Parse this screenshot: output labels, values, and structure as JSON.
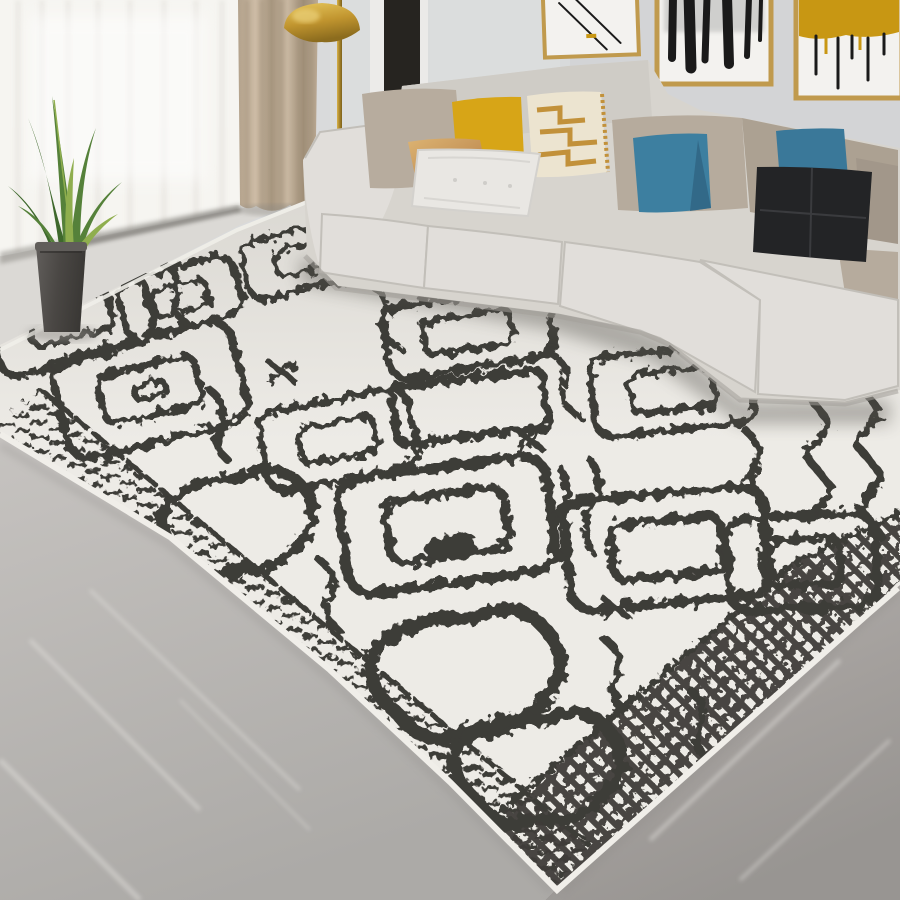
{
  "scene": {
    "setting": "bright living room corner: L-shaped light gray sectional sofa with throw pillows on a large ivory berber-style rug, gold-framed abstract wall art, brass dome floor lamp, sheer white and beige curtains, snake plant in a dark pot, gray marble tile floor",
    "colors": {
      "wall": "#d9dadb",
      "wall-dark": "#cdcfd1",
      "sheer": "#f6f5f1",
      "sheer-shade": "#e6e4df",
      "drape": "#c0af9a",
      "drape-dark": "#a2917a",
      "drape-light": "#d2c3ae",
      "molding": "#ecebe9",
      "panel-dark": "#262420",
      "frame-gold": "#c09a4d",
      "art-bg": "#f3f2ef",
      "art-ink": "#1a1a1a",
      "art-mustard": "#c89713",
      "lamp-gold": "#c79b33",
      "lamp-gold-dark": "#8f6f1d",
      "lamp-gold-light": "#ecd27a",
      "sofa": "#d7d4ce",
      "sofa-light": "#e1deda",
      "sofa-mid": "#cfccc6",
      "sofa-dark": "#a39f99",
      "cushion-taupe": "#b6ab9d",
      "cushion-taupe-mid": "#aca192",
      "cushion-taupe-dark": "#a2978a",
      "rug-base": "#edebe6",
      "rug-ink": "#3e3c38",
      "rug-shade": "#c9c6c0",
      "binding": "#f0eee9",
      "floor-light": "#dbd9d5",
      "floor-mid": "#c1beba",
      "floor-dark": "#a6a3a0",
      "floor-streak": "#e3e1dd",
      "plant-green": "#55813a",
      "plant-green-dark": "#3e682c",
      "plant-green-light": "#8fae4e",
      "pot": "#4c4947",
      "pot-light": "#605d5a"
    },
    "window": {
      "sheer_curtain": "white floor-length sheer curtain",
      "side_curtain": "beige drape panel with vertical folds"
    },
    "wall_art": [
      {
        "name": "abstract art, thin black diagonal strokes on white, gold frame"
      },
      {
        "name": "abstract art, bold black and white vertical brushwork, gold frame"
      },
      {
        "name": "abstract art, mustard gold field with black drips on white, gold frame"
      }
    ],
    "floor_lamp": {
      "style": "brass dome floor lamp with slim gold pole"
    },
    "plant": {
      "type": "snake plant (sansevieria)",
      "pot": "dark gray tapered cylinder pot"
    },
    "sofa": {
      "type": "L-shaped sectional",
      "upholstery": "light warm gray fabric",
      "back_cushions": "taupe",
      "pillows": [
        {
          "name": "taupe-back-pillow",
          "color": "#b7ac9e"
        },
        {
          "name": "mustard-yellow-pillow",
          "color": "#d7a517"
        },
        {
          "name": "gold-greek-key-pillow",
          "color": "#ece4d0",
          "accent": "#c2913a"
        },
        {
          "name": "gold-satin-pillow",
          "color": "#c69559"
        },
        {
          "name": "white-quilted-pillow",
          "color": "#e9e7e3"
        },
        {
          "name": "teal-pillow-left",
          "color": "#3d7fa0"
        },
        {
          "name": "teal-pillow-right",
          "color": "#3a7899"
        },
        {
          "name": "black-pillow",
          "color": "#232426"
        }
      ]
    },
    "rug": {
      "style": "Moroccan berber diamond trellis, hand-drawn look",
      "base": "ivory",
      "pattern_ink": "charcoal",
      "motifs": "concentric jagged diamonds, open shield/heart outlines, zigzag chains",
      "borders": [
        "hatched dash band along lower-left edge",
        "dense diamond lattice band along lower-right edge"
      ]
    },
    "floor": {
      "material": "gray marble tile, brighter near window"
    }
  }
}
